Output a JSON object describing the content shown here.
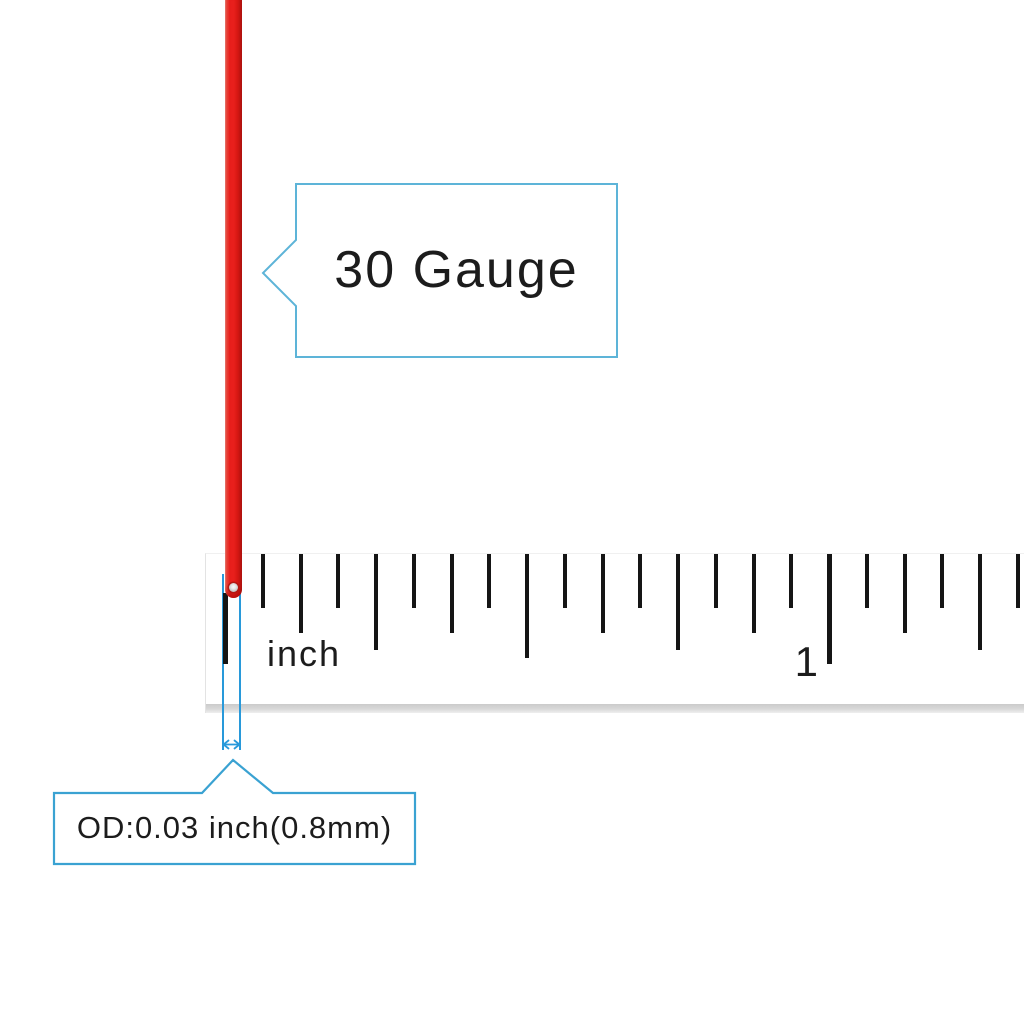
{
  "callouts": {
    "gauge_label": "30 Gauge",
    "od_label": "OD:0.03 inch(0.8mm)"
  },
  "ruler": {
    "unit_label": "inch",
    "mark_1_label": "1",
    "left_edge_x": 205,
    "zero_x": 224,
    "sixteenth_spacing_px": 37.75,
    "tick_count": 22,
    "zero_tick_top_offset": 39,
    "tick_lengths": {
      "inch": 110,
      "half": 104,
      "quarter": 96,
      "eighth": 79,
      "sixteenth": 54
    }
  },
  "colors": {
    "page_bg": "#ffffff",
    "wire_red": "#e81f1c",
    "wire_red_dark": "#b31411",
    "wire_red_light": "#f7978c",
    "callout_border_light": "#5db4d8",
    "callout_border_strong": "#3aa2d2",
    "measure_blue": "#2899da",
    "tick_black": "#151515",
    "text_black": "#1c1c1c"
  }
}
